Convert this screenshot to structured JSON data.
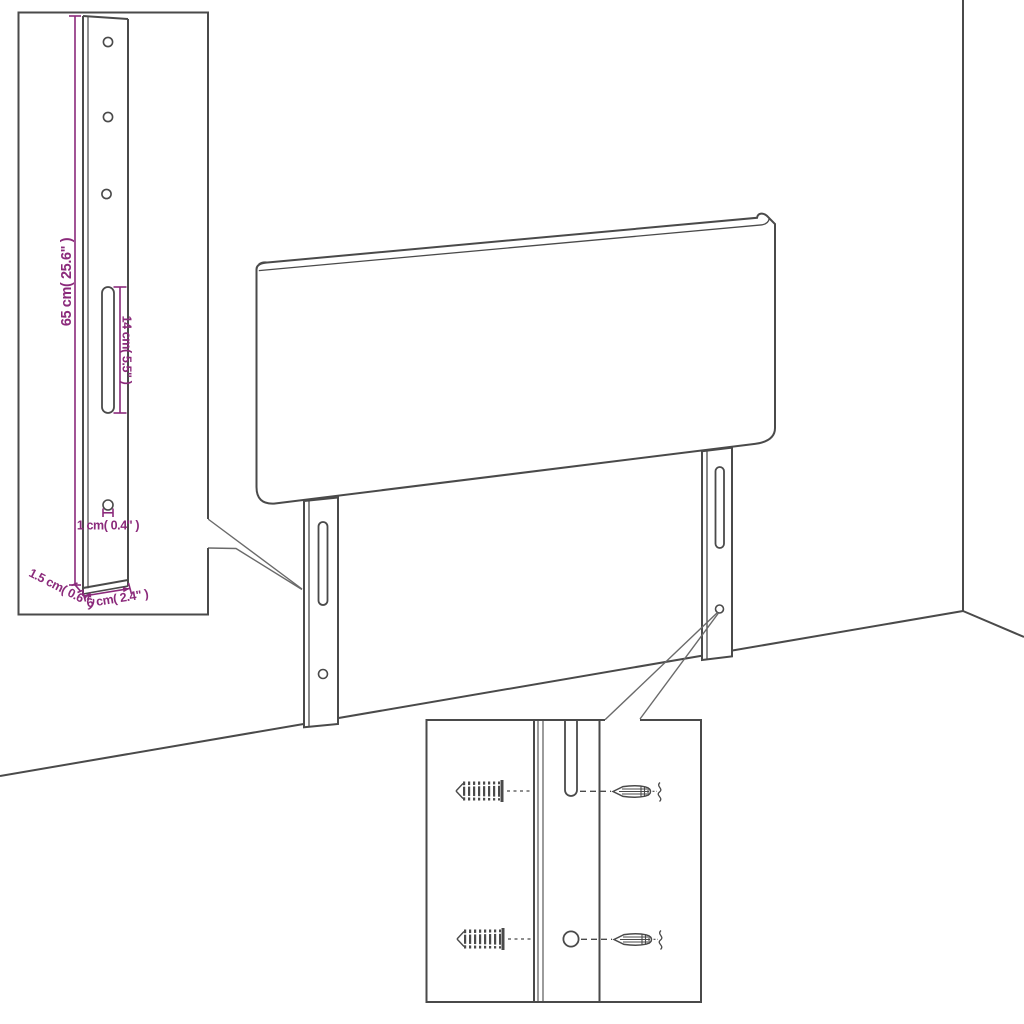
{
  "diagram": {
    "colors": {
      "line": "#4a4a4a",
      "dimension": "#8B2A7B",
      "background": "#ffffff"
    },
    "dims": {
      "height": "65 cm( 25.6\" )",
      "slot": "14 cm( 5.5\" )",
      "hole": "1 cm( 0.4\" )",
      "thickness": "1.5 cm( 0.6\" )",
      "width": "6 cm( 2.4\" )"
    }
  }
}
